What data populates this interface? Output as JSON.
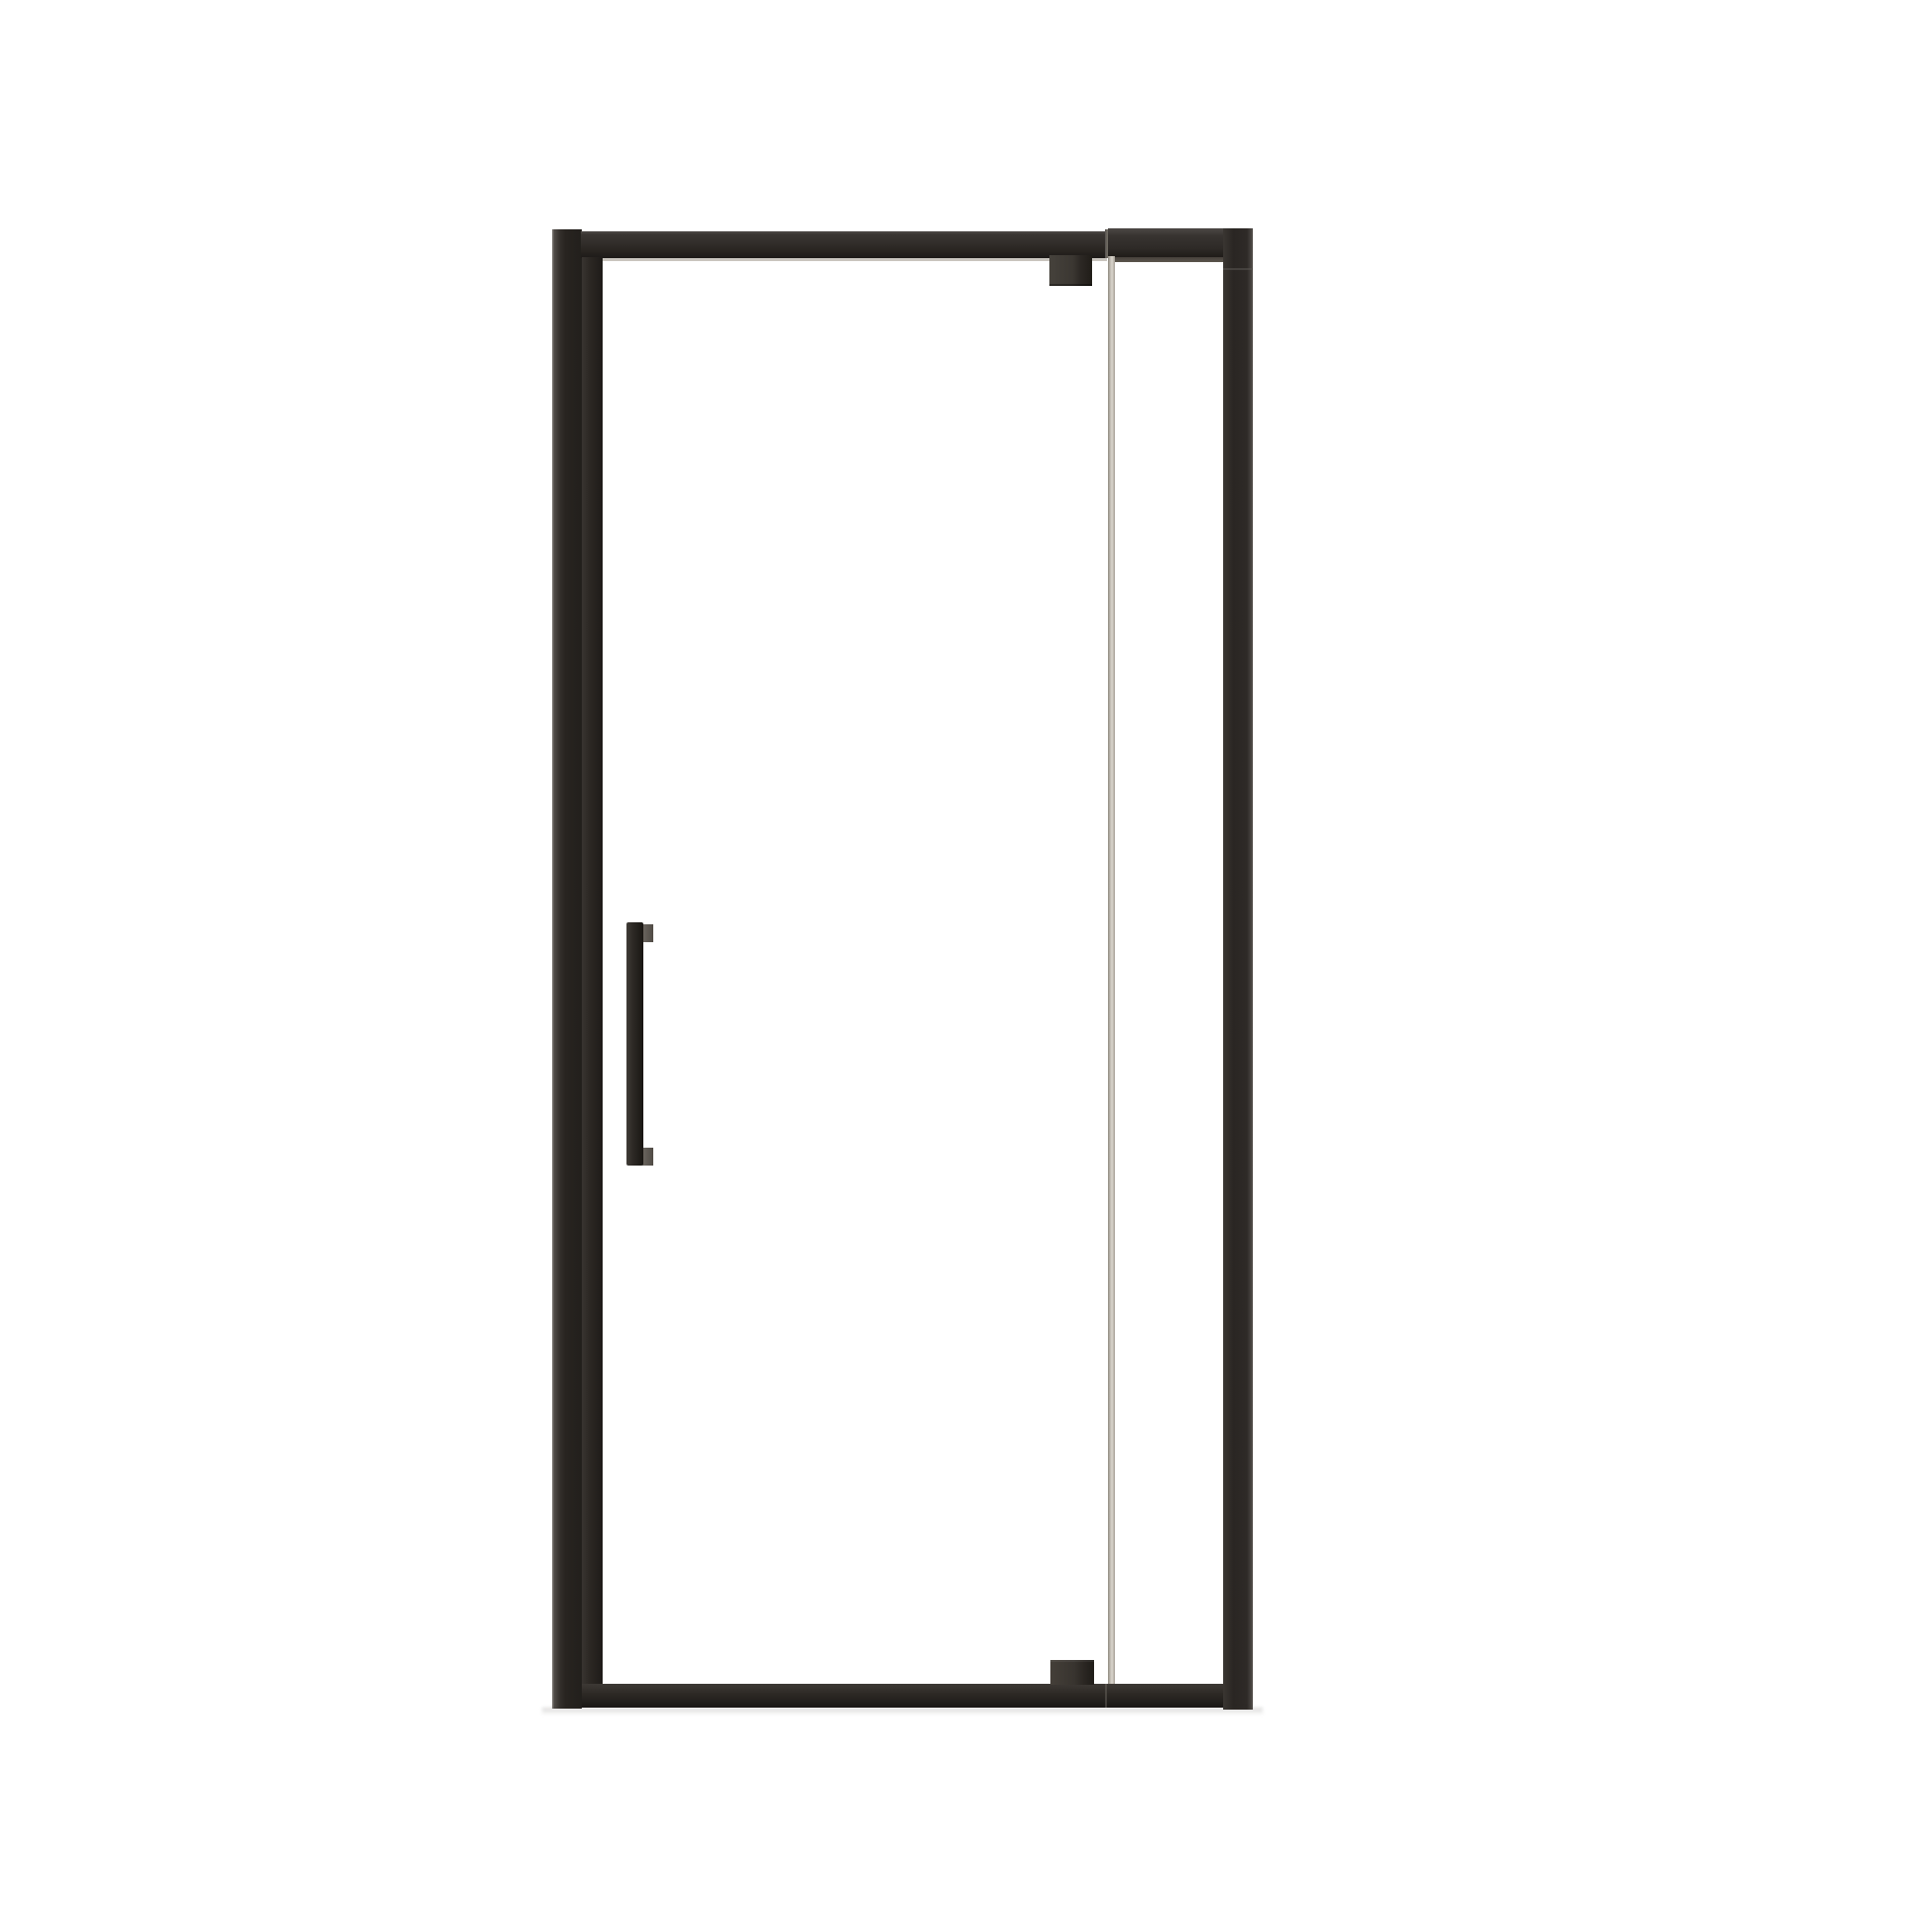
{
  "image": {
    "kind": "product-photo",
    "description": "Matte black framed pivot shower door with clear glass door, inline fixed glass panel, top and bottom pivot hinges and a vertical bar handle, photographed on a plain white background",
    "background_color": "#ffffff"
  },
  "product": {
    "type": "Pivot shower door with inline fixed panel",
    "frame_finish": "matte black",
    "glass_type": "clear glass",
    "parts": {
      "unit": "Shower door unit",
      "left_wall_profile": "Left wall profile",
      "top_rail_door": "Top rail (door section)",
      "top_rail_seam": "Top rail joint",
      "top_rail_panel": "Top rail (fixed panel section)",
      "door_stile": "Door hinge-side stile",
      "door_glass": "Clear glass door panel",
      "door_handle": "Vertical bar handle",
      "handle_mount_top": "Handle mount, top",
      "handle_mount_bottom": "Handle mount, bottom",
      "top_pivot_hinge": "Top pivot hinge block",
      "bottom_pivot_hinge": "Bottom pivot hinge block",
      "glass_edge": "Door glass edge strip",
      "fixed_panel_glass": "Fixed clear glass panel",
      "right_wall_profile": "Right wall profile",
      "bottom_rail": "Bottom rail",
      "glass_top_highlight": "Glass top edge highlight",
      "panel_shadow_band": "Shadow band under fixed panel rail",
      "floor_shadow": "Floor shadow"
    },
    "colors": {
      "frame": "#2a2623",
      "frame_highlight": "#4a4643",
      "frame_shadow": "#1c1917",
      "glass_edge_strip": "#cfcac2",
      "glass_highlight_line": "#c9c5be",
      "handle_mount": "#5f5a53",
      "floor_shadow": "#dddcda",
      "background": "#ffffff"
    }
  }
}
